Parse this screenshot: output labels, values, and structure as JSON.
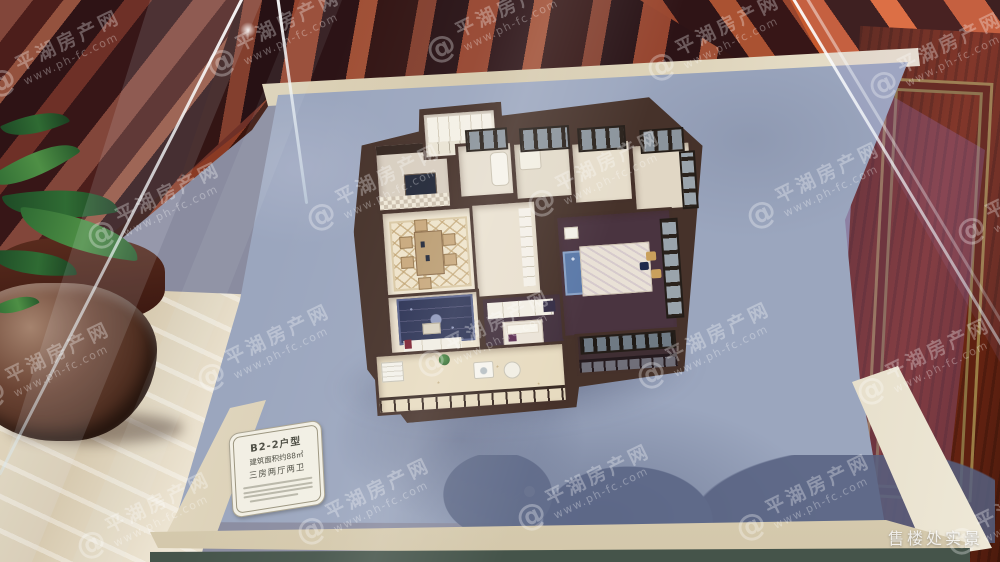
{
  "watermark": {
    "site_name": "平湖房产网",
    "site_url": "www.ph-fc.com",
    "at_symbol": "@"
  },
  "placard": {
    "unit_type": "B2-2户型",
    "area": "建筑面积约88㎡",
    "layout": "三房两厅两卫"
  },
  "caption": {
    "text": "售楼处实景"
  },
  "colors": {
    "base_board": "#9ba6be",
    "wood_orange": "#c75a2e",
    "wood_dark": "#2b110c",
    "marble": "#e3dac4",
    "model_wall": "#46322a"
  }
}
